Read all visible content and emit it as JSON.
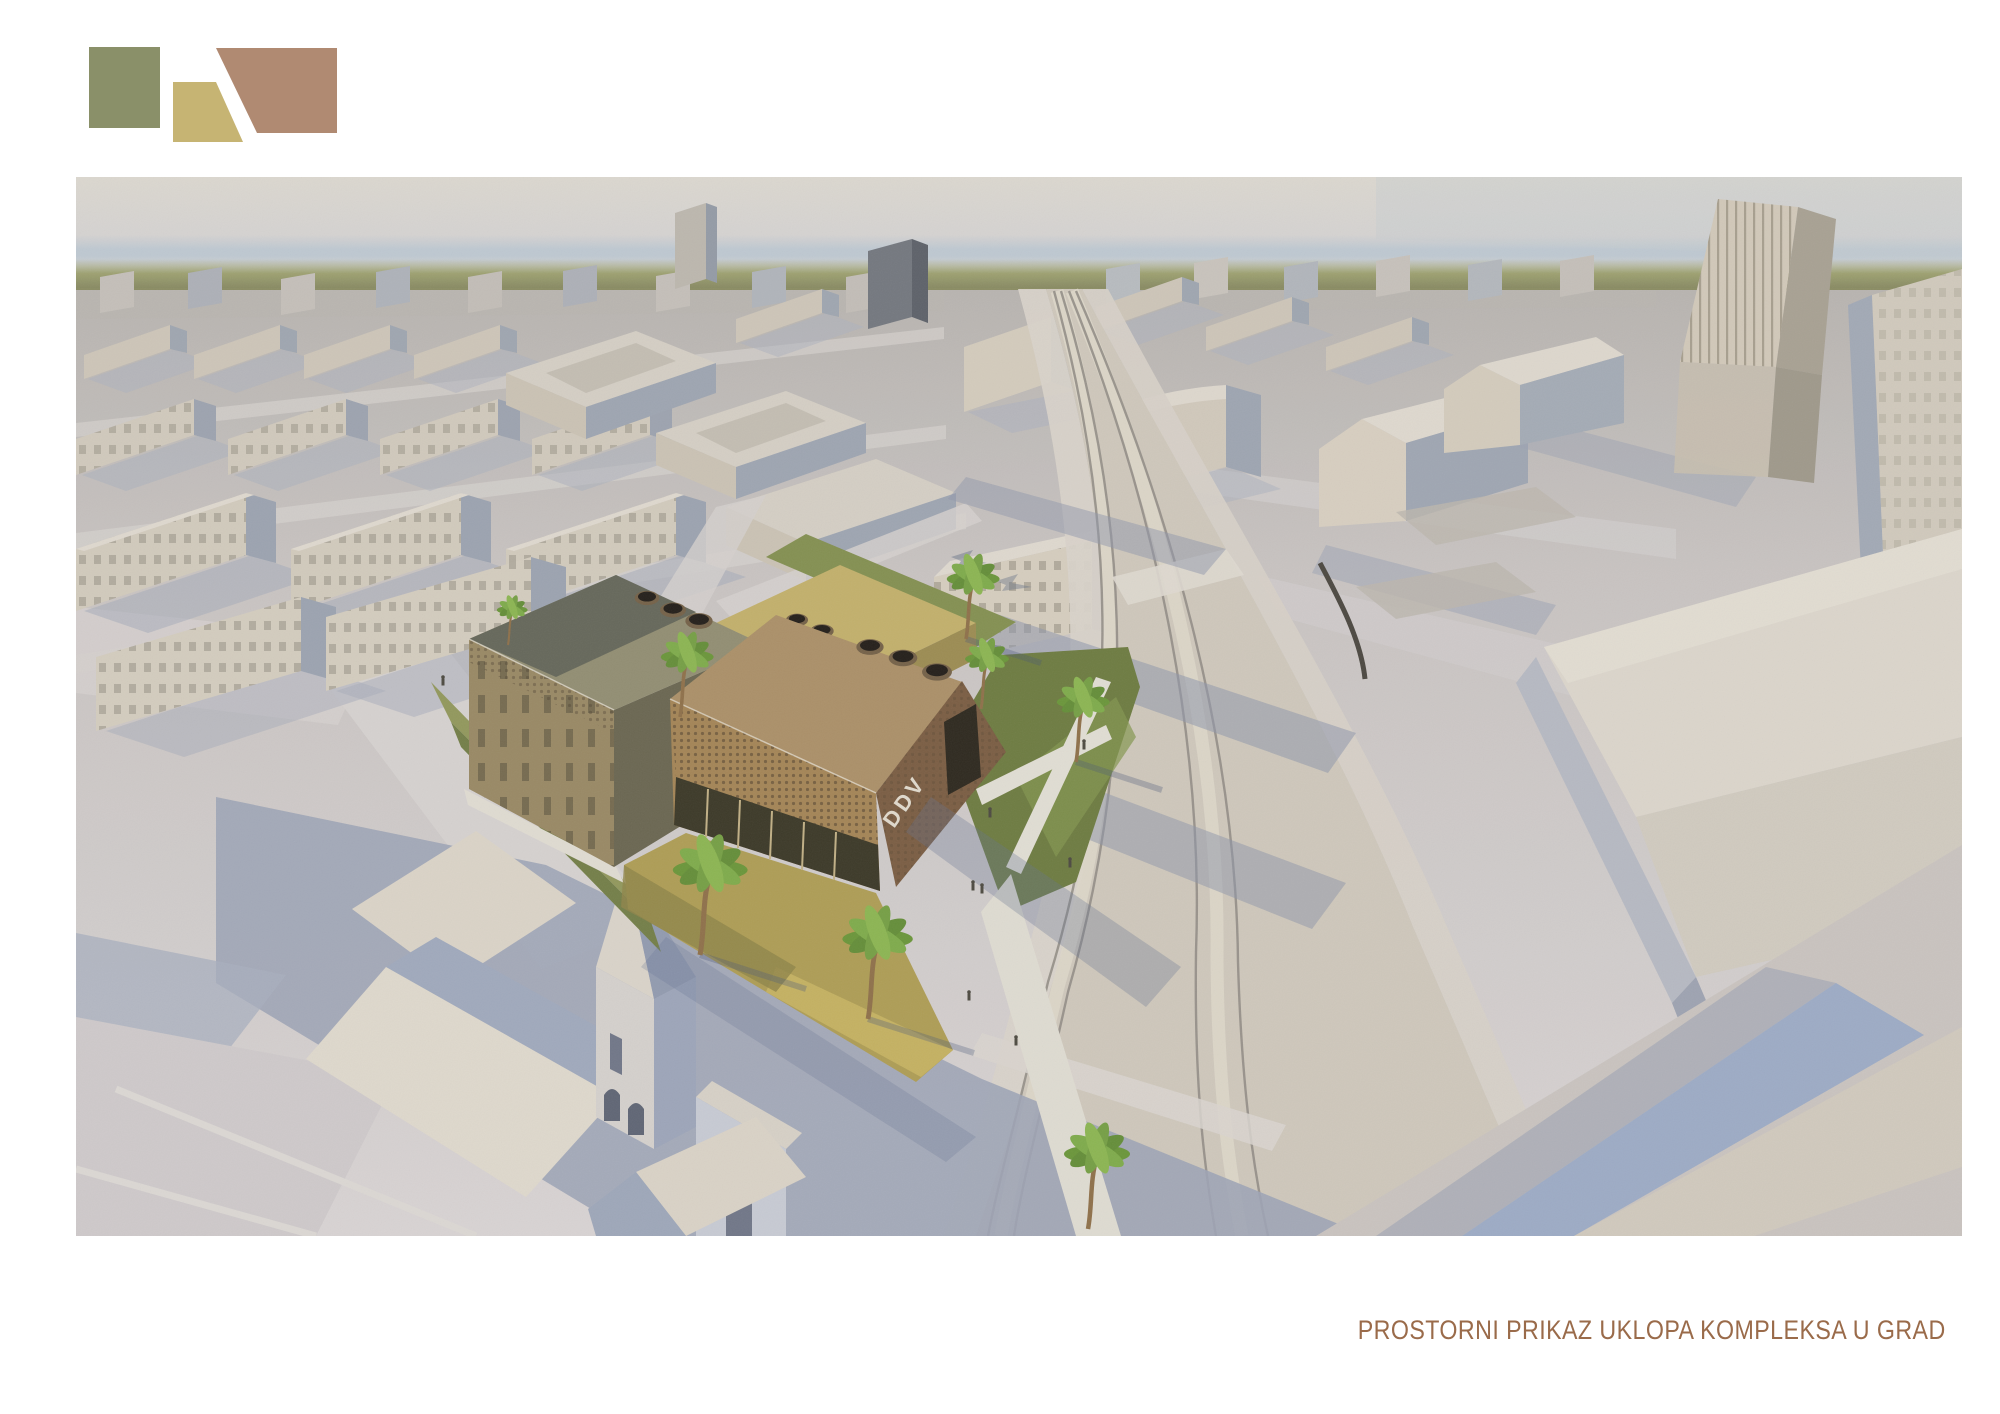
{
  "board": {
    "background_color": "#ffffff",
    "caption": "PROSTORNI PRIKAZ UKLOPA KOMPLEKSA U GRAD",
    "caption_color": "#9a6b4a"
  },
  "logo": {
    "shape_colors": {
      "square_green": "#8a9069",
      "wedge_tan": "#c6b473",
      "trapezoid_brown": "#b08a72"
    }
  },
  "render": {
    "description": "Aerial 3D massing view of a city: brick community complex with palm trees beside a curving tram boulevard, church at lower left, high-rise tower upper right",
    "building_sign": "DDV",
    "palette": {
      "sky_top": "#dad7d0",
      "sky_horizon_blue": "#bcc7d2",
      "treeline_green": "#969a6b",
      "ground_far": "#b5b2af",
      "ground_near": "#d7d3d4",
      "road": "#ccc6ba",
      "tram_rail": "#8e8a84",
      "shadow_blue": "#98a1b4",
      "facade_lit": "#d0c9bc",
      "facade_shadow": "#98a0ae",
      "facade_a": "#94845f",
      "roof_a": "#8d8a6e",
      "brick_front": "#a08050",
      "brick_side": "#74573c",
      "brick_roof": "#a78c63",
      "sand_building": "#c0ae66",
      "lawn": "#8d9457",
      "lawn_shadow": "#66763a",
      "plaza_ochre": "#ab9a4f",
      "palm_green": "#6f9c3e",
      "church_roof_lit": "#dcd6ca",
      "church_roof_shade": "#9aa4ba"
    }
  }
}
